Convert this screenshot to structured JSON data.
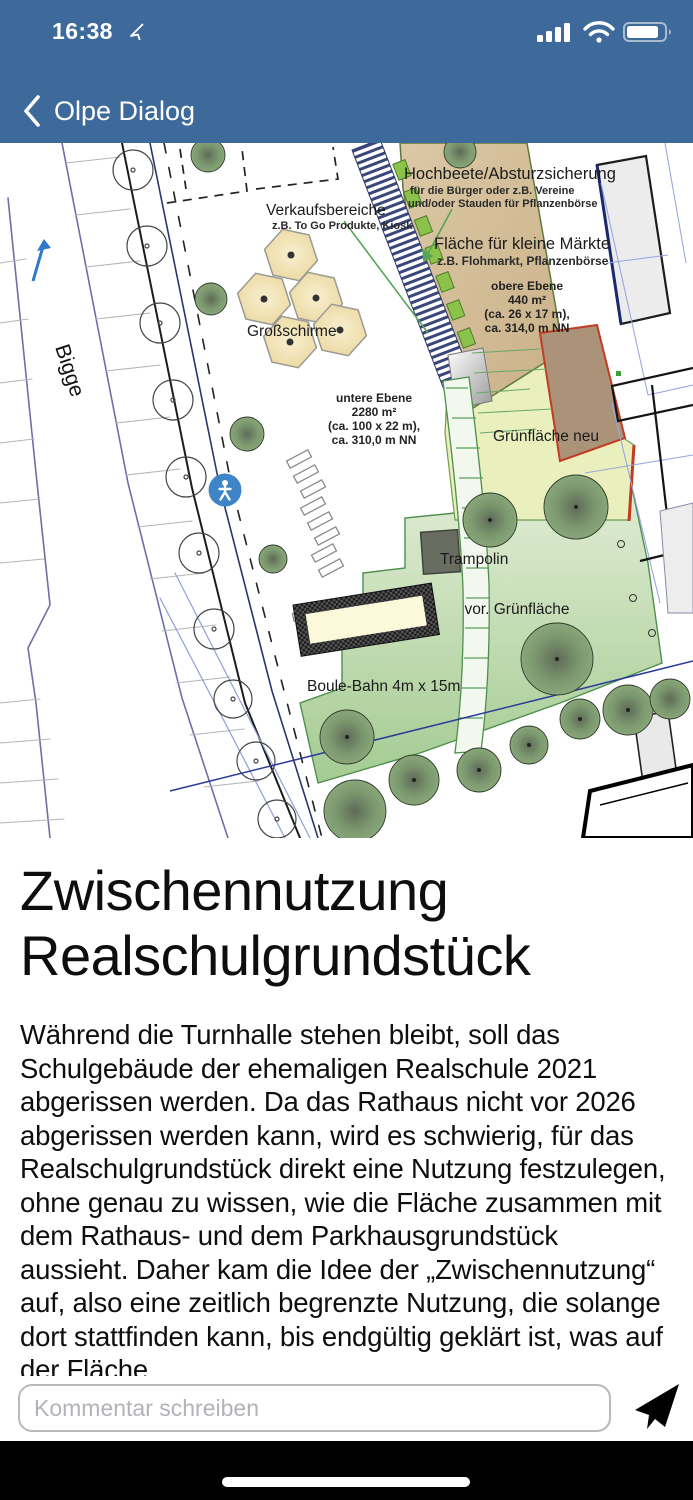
{
  "status": {
    "time": "16:38"
  },
  "nav": {
    "title": "Olpe Dialog"
  },
  "colors": {
    "nav_bar": "#3d6a9a",
    "send_icon": "#000000",
    "map_tan": "#d6c19c",
    "map_yellow_green": "#e9efbd",
    "map_light_green": "#cfe2bd",
    "pedestrian_badge": "#3d85c6"
  },
  "map": {
    "labels": {
      "bigge": "Bigge",
      "verkauf_title": "Verkaufsbereiche",
      "verkauf_sub": "z.B. To Go Produkte, Kiosk",
      "hochbeete_title": "Hochbeete/Absturzsicherung",
      "hochbeete_sub1": "für die Bürger oder z.B. Vereine",
      "hochbeete_sub2": "und/oder Stauden für Pflanzenbörse",
      "maerkte_title": "Fläche für kleine Märkte",
      "maerkte_sub": "z.B. Flohmarkt, Pflanzenbörse",
      "obere1": "obere Ebene",
      "obere2": "440 m²",
      "obere3": "(ca. 26 x 17 m),",
      "obere4": "ca. 314,0 m NN",
      "grossschirme": "Großschirme",
      "untere1": "untere Ebene",
      "untere2": "2280 m²",
      "untere3": "(ca. 100 x 22 m),",
      "untere4": "ca. 310,0 m NN",
      "gruenflaeche_neu": "Grünfläche neu",
      "trampolin": "Trampolin",
      "vor_gruenflaeche": "vor. Grünfläche",
      "boule": "Boule-Bahn 4m x 15m"
    }
  },
  "article": {
    "title": "Zwischennutzung Realschulgrundstück",
    "body": "Während die Turnhalle stehen bleibt, soll das Schulgebäude der ehemaligen Realschule 2021 abgerissen werden. Da das Rathaus nicht vor 2026 abgerissen werden kann, wird es schwierig, für das Realschulgrundstück direkt eine Nutzung festzulegen, ohne genau zu wissen, wie die Fläche zusammen mit dem Rathaus- und dem Parkhausgrundstück aussieht. Daher kam die Idee der „Zwischennutzung“ auf, also eine zeitlich begrenzte Nutzung, die solange dort stattfinden kann, bis endgültig geklärt ist, was auf der Fläche"
  },
  "comment": {
    "placeholder": "Kommentar schreiben"
  }
}
